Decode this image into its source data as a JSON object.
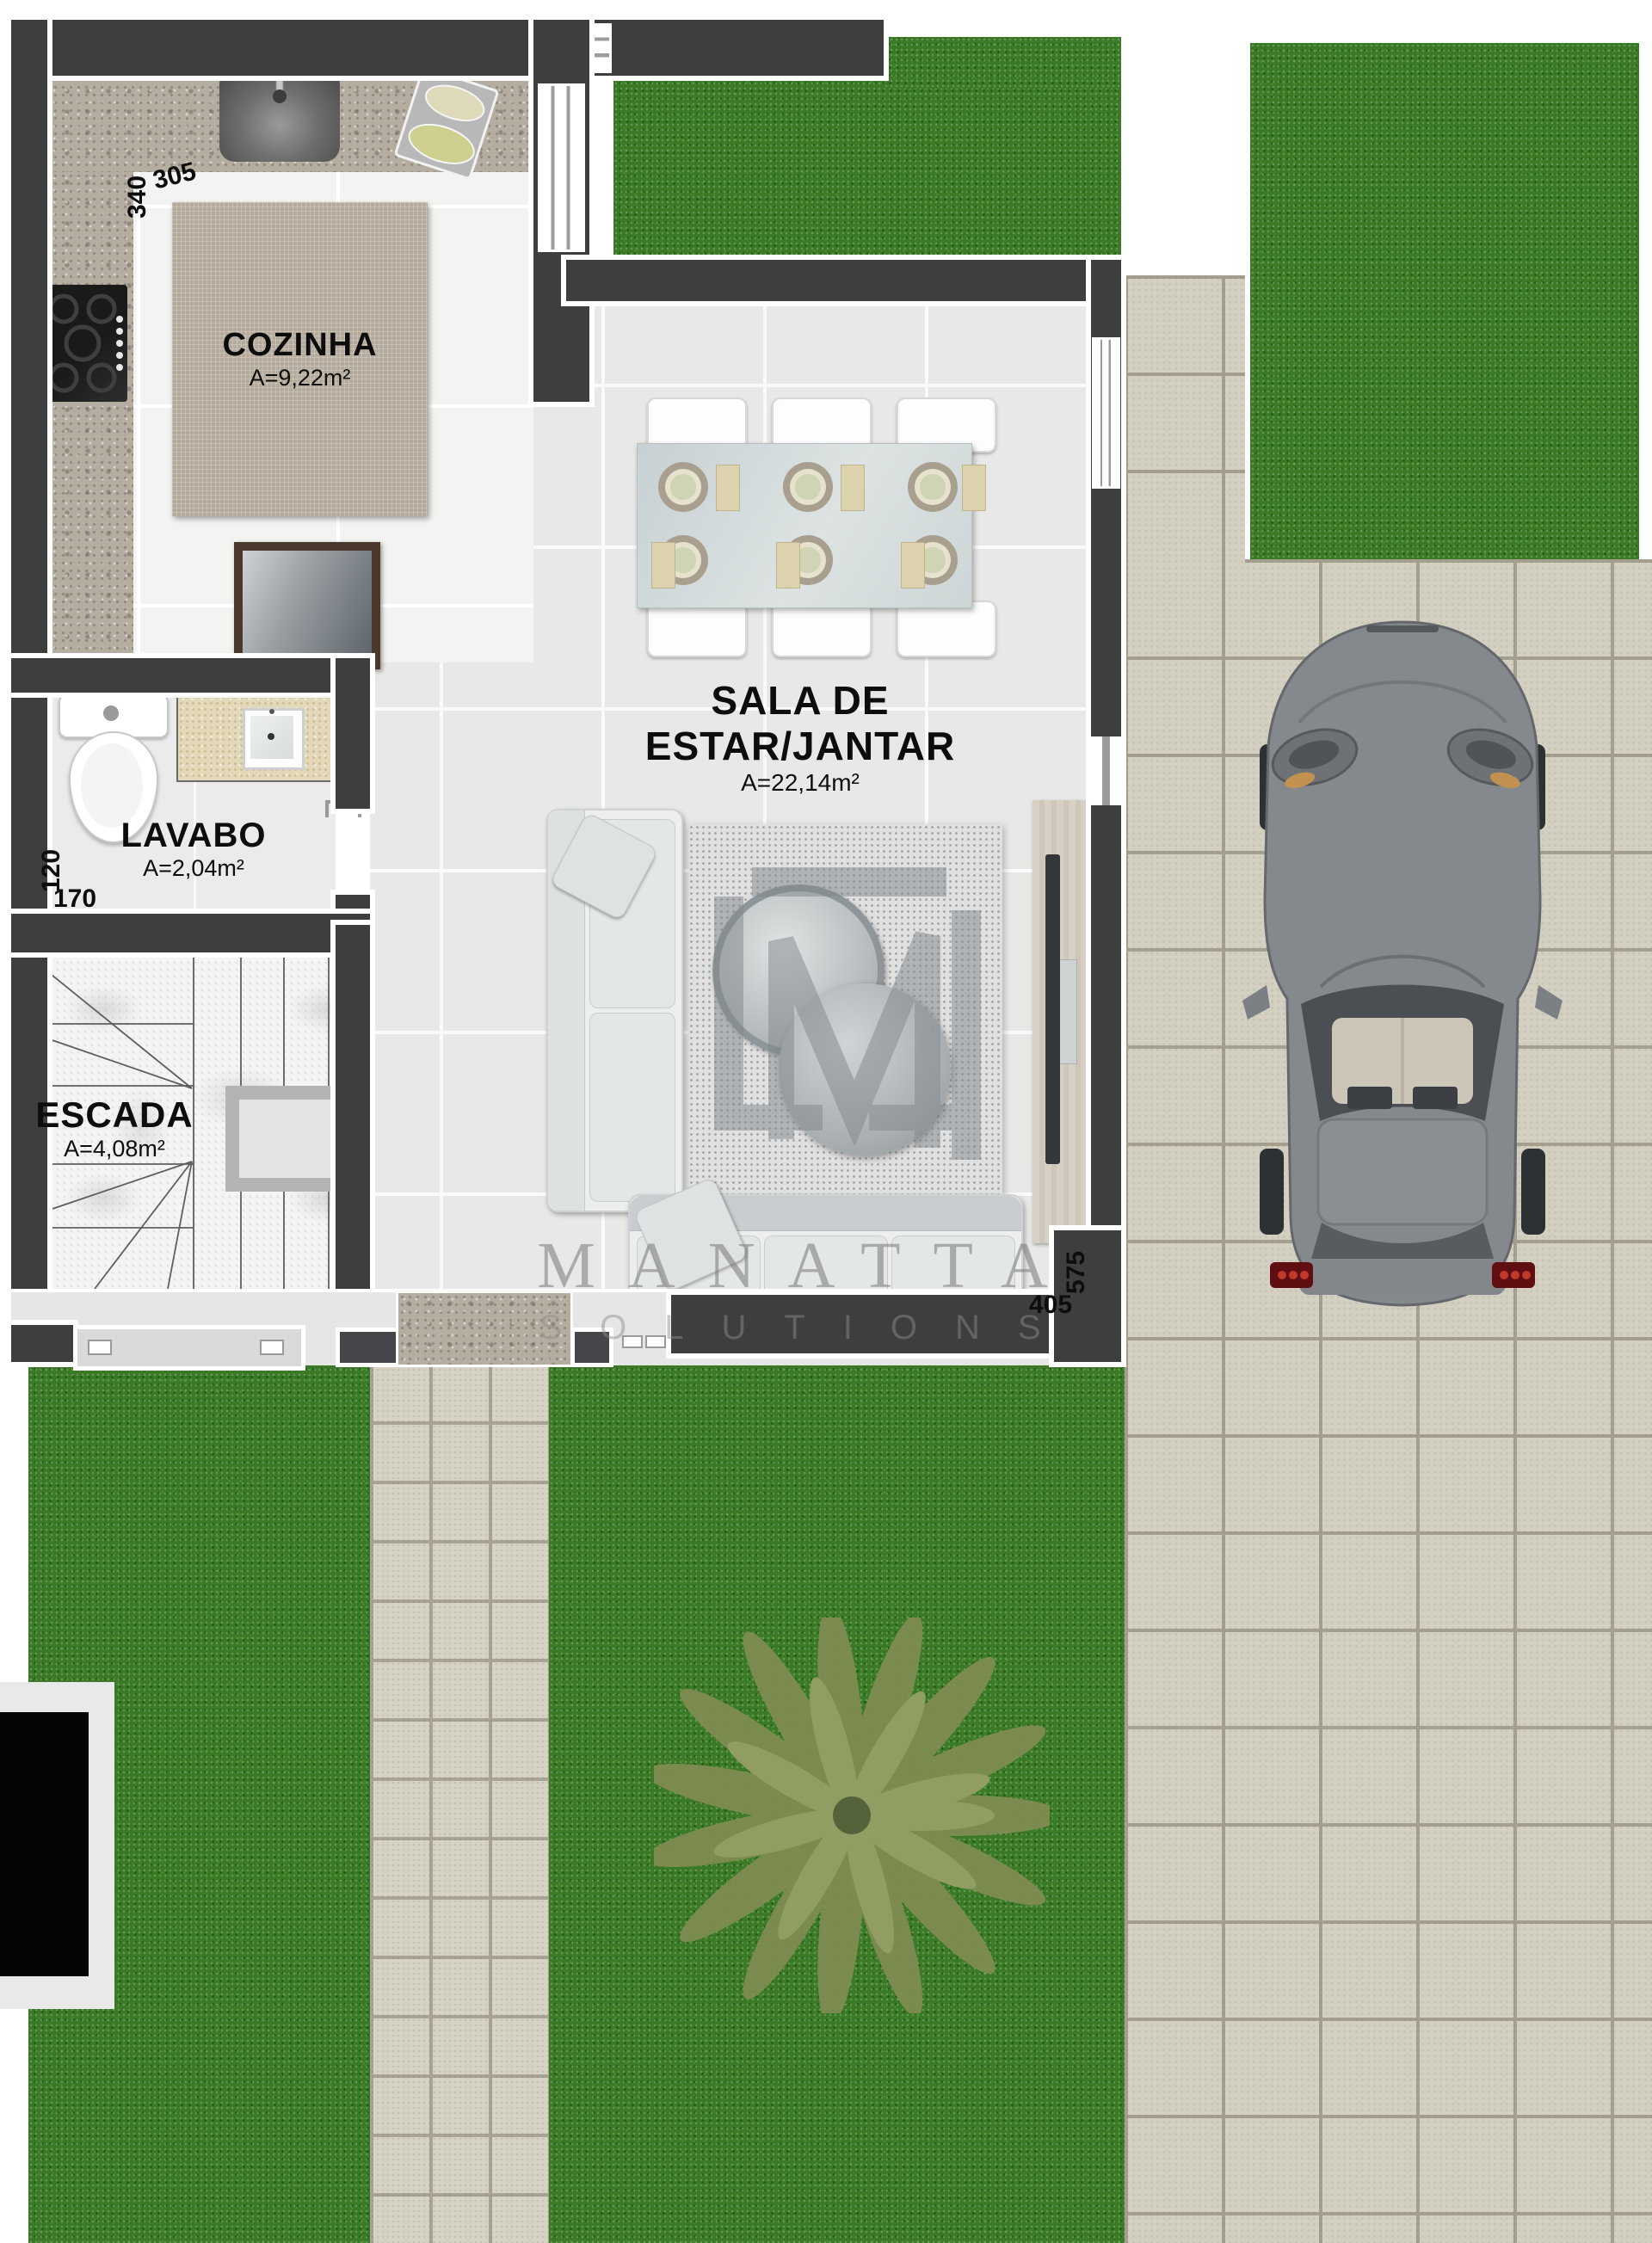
{
  "plan": {
    "rooms": {
      "cozinha": {
        "name": "COZINHA",
        "area": "A=9,22m²"
      },
      "sala": {
        "name": "SALA DE ESTAR/JANTAR",
        "area": "A=22,14m²"
      },
      "lavabo": {
        "name": "LAVABO",
        "area": "A=2,04m²"
      },
      "escada": {
        "name": "ESCADA",
        "area": "A=4,08m²"
      }
    },
    "dimensions": {
      "d305": "305",
      "d340": "340",
      "d120": "120",
      "d170": "170",
      "d575": "575",
      "d405": "405"
    }
  },
  "watermark": {
    "brand": "MANATTA",
    "tagline": "SOLUTIONS"
  },
  "colors": {
    "wall": "#3e3e3e",
    "grass": "#3a7a26",
    "paver": "#d3d0c2",
    "floor": "#e8e8e7",
    "accent_rug": "#b5ab9c"
  }
}
